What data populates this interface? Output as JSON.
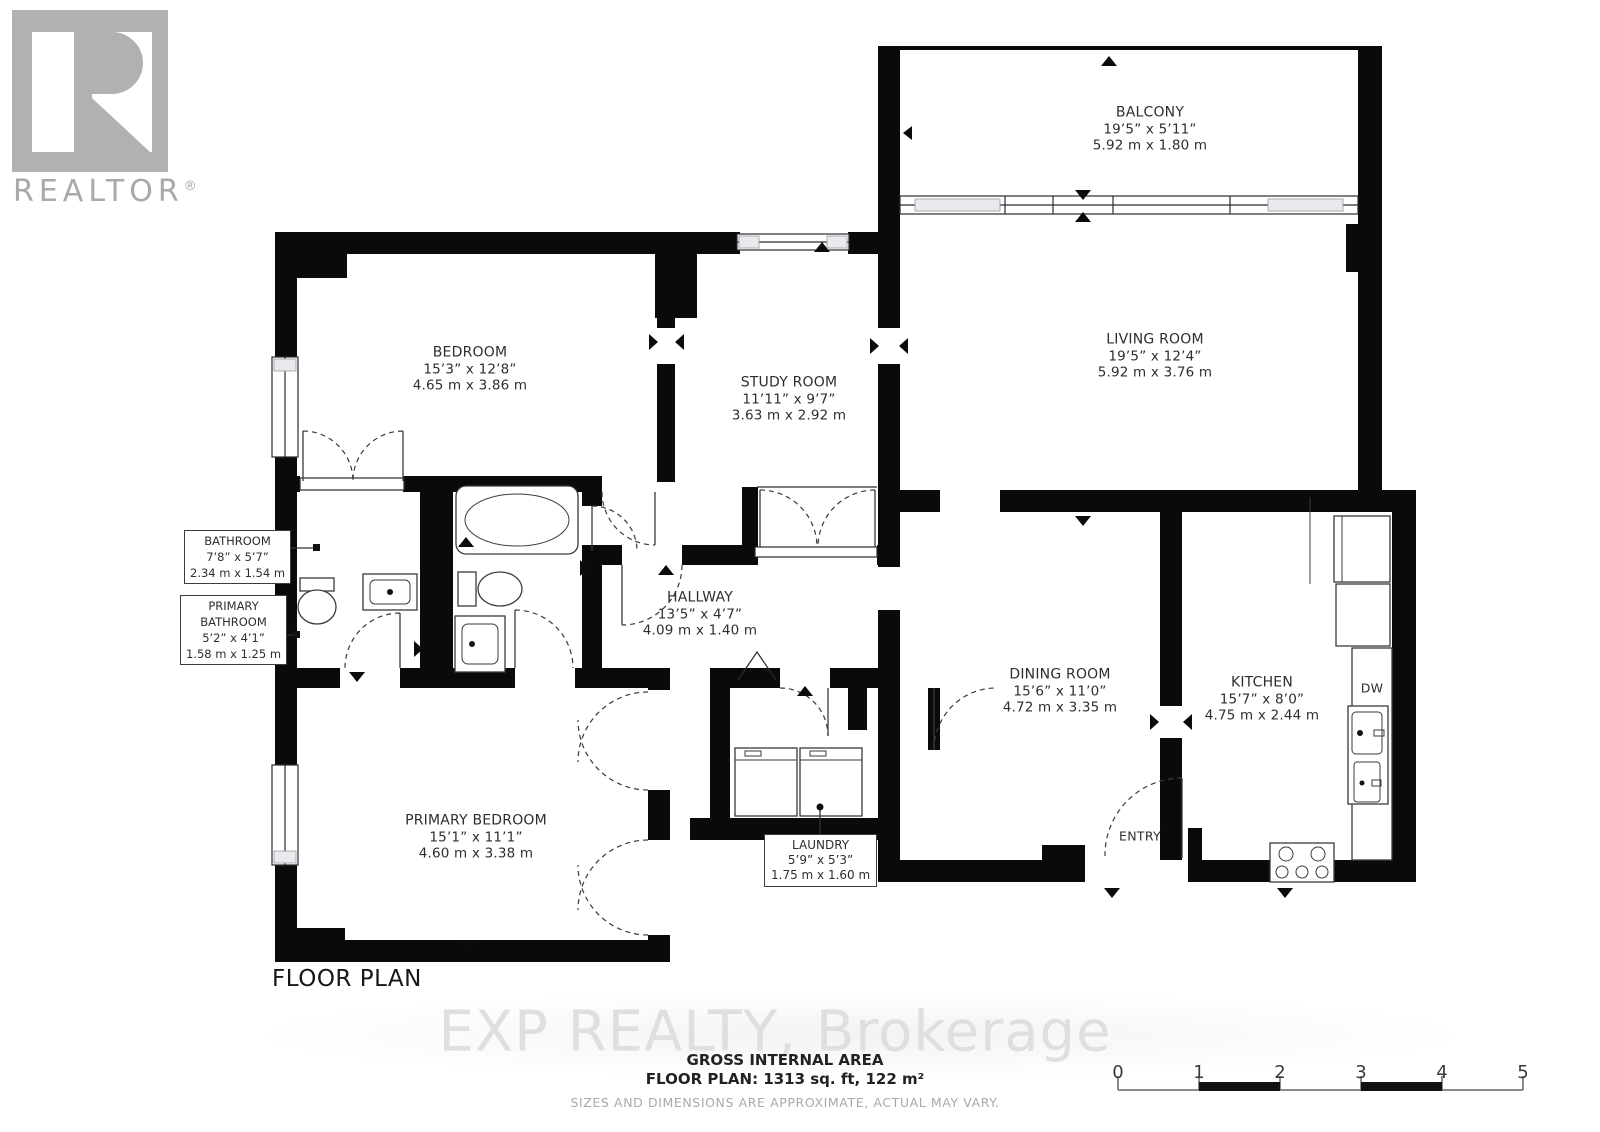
{
  "branding": {
    "logo_text": "REALTOR",
    "logo_reg": "®",
    "watermark": "EXP REALTY, Brokerage"
  },
  "title": "FLOOR PLAN",
  "rooms": {
    "balcony": {
      "name": "BALCONY",
      "imperial": "19’5” x 5’11”",
      "metric": "5.92 m x 1.80 m"
    },
    "living_room": {
      "name": "LIVING ROOM",
      "imperial": "19’5” x 12’4”",
      "metric": "5.92 m x 3.76 m"
    },
    "bedroom": {
      "name": "BEDROOM",
      "imperial": "15’3” x 12’8”",
      "metric": "4.65 m x 3.86 m"
    },
    "study_room": {
      "name": "STUDY ROOM",
      "imperial": "11’11” x 9’7”",
      "metric": "3.63 m x 2.92 m"
    },
    "bathroom": {
      "name": "BATHROOM",
      "imperial": "7’8” x 5’7”",
      "metric": "2.34 m x 1.54 m"
    },
    "primary_bathroom": {
      "name_line1": "PRIMARY",
      "name_line2": "BATHROOM",
      "imperial": "5’2” x 4’1”",
      "metric": "1.58 m x 1.25 m"
    },
    "hallway": {
      "name": "HALLWAY",
      "imperial": "13’5” x 4’7”",
      "metric": "4.09 m x 1.40 m"
    },
    "primary_bedroom": {
      "name": "PRIMARY BEDROOM",
      "imperial": "15’1” x 11’1”",
      "metric": "4.60 m x 3.38 m"
    },
    "laundry": {
      "name": "LAUNDRY",
      "imperial": "5’9” x 5’3”",
      "metric": "1.75 m x 1.60 m"
    },
    "dining_room": {
      "name": "DINING ROOM",
      "imperial": "15’6” x 11’0”",
      "metric": "4.72 m x 3.35 m"
    },
    "kitchen": {
      "name": "KITCHEN",
      "imperial": "15’7” x 8’0”",
      "metric": "4.75 m x 2.44 m"
    },
    "entry": {
      "name": "ENTRY"
    },
    "dishwasher": {
      "name": "DW"
    }
  },
  "footer": {
    "area_title": "GROSS INTERNAL AREA",
    "area_value": "FLOOR PLAN: 1313 sq. ft, 122 m²",
    "disclaimer": "SIZES AND DIMENSIONS ARE APPROXIMATE, ACTUAL MAY VARY."
  },
  "scale": {
    "labels": [
      "0",
      "1",
      "2",
      "3",
      "4",
      "5"
    ]
  },
  "colors": {
    "wall": "#0a0a0a",
    "logo_gray": "#b2b0b1",
    "watermark_gray": "#dfdfe2",
    "text": "#2e2e2e",
    "muted": "#a9a9a9"
  }
}
